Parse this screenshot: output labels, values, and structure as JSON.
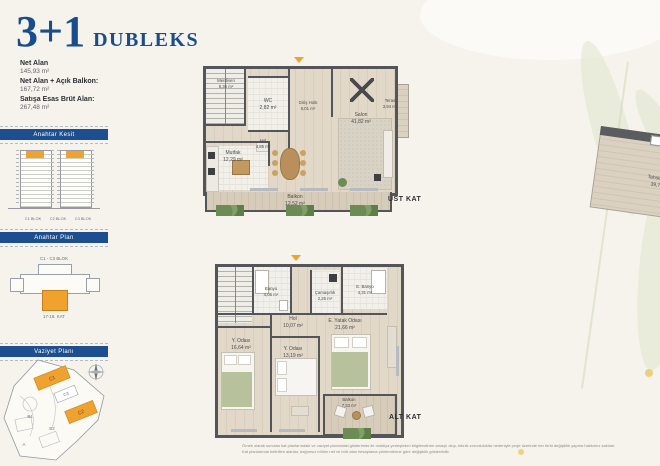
{
  "header": {
    "title_big": "3+1",
    "title_small": "DUBLEKS",
    "area_rows": [
      {
        "label": "Net Alan",
        "value": "145,93 m²"
      },
      {
        "label": "Net Alan + Açık Balkon:",
        "value": "167,72 m²"
      },
      {
        "label": "Satışa Esas Brüt Alan:",
        "value": "267,48 m²"
      }
    ]
  },
  "sidebar": {
    "kesit": {
      "title": "Anahtar Kesit",
      "block_labels": [
        "C1 BLOK",
        "C2 BLOK",
        "C3 BLOK"
      ]
    },
    "anahtar_plan": {
      "title": "Anahtar Plan",
      "top_label": "C1 - C3 BLOK",
      "bottom_label": "17-18. KAT"
    },
    "vaziyet": {
      "title": "Vaziyet Planı",
      "labels": {
        "c1": "C1",
        "c2": "C2",
        "c3": "C3",
        "b1": "B1",
        "b2": "B2",
        "a": "A"
      }
    }
  },
  "upper_plan": {
    "caption": "ÜST KAT",
    "rooms": {
      "merdiven": {
        "name": "Merdiven",
        "area": "8,36 m²"
      },
      "wc": {
        "name": "WC",
        "area": "2,82 m²"
      },
      "giris_holu": {
        "name": "Giriş Holü",
        "area": "6,01 m²"
      },
      "hol": {
        "name": "Hol",
        "area": "4,85 m²"
      },
      "mutfak": {
        "name": "Mutfak",
        "area": "12,29 m²"
      },
      "salon": {
        "name": "Salon",
        "area": "41,82 m²"
      },
      "teras": {
        "name": "Teras",
        "area": "3,94 m²"
      },
      "tahsisli_alan": {
        "name": "Tahsisli Alan",
        "area": "39,76 m²"
      },
      "balkon": {
        "name": "Balkon",
        "area": "12,52 m²"
      }
    }
  },
  "lower_plan": {
    "caption": "ALT KAT",
    "rooms": {
      "banyo": {
        "name": "Banyo",
        "area": "4,05 m²"
      },
      "camasirlik": {
        "name": "Çamaşırlık",
        "area": "2,25 m²"
      },
      "e_banyo": {
        "name": "E. Banyo",
        "area": "4,31 m²"
      },
      "hol": {
        "name": "Hol",
        "area": "10,07 m²"
      },
      "y_odasi_1": {
        "name": "Y. Odası",
        "area": "16,64 m²"
      },
      "y_odasi_2": {
        "name": "Y. Odası",
        "area": "13,19 m²"
      },
      "e_yatak_odasi": {
        "name": "E. Yatak Odası",
        "area": "21,66 m²"
      },
      "balkon": {
        "name": "Balkon",
        "area": "7,33 m²"
      }
    }
  },
  "footer": {
    "disclaimer_line1": "Örnek olarak sunulan kat planlarındaki ve vaziyet planındaki gösterimler ile mobilya yerleşimleri bilgilendirme amaçlı olup, teknik zorunluluklar nedeniyle proje üzerinde her türlü değişiklik yapma hakkımız saklıdır.",
    "disclaimer_line2": "Kat planlarında belirtilen alanlar, bağımsız bölüm net ve brüt alan hesaplama yöntemlerine göre değişiklik gösterebilir."
  },
  "colors": {
    "accent_blue": "#1d4e8f",
    "highlight_orange": "#f0a22e",
    "background_cream": "#f5f3ec",
    "wall_gray": "#54555a"
  }
}
